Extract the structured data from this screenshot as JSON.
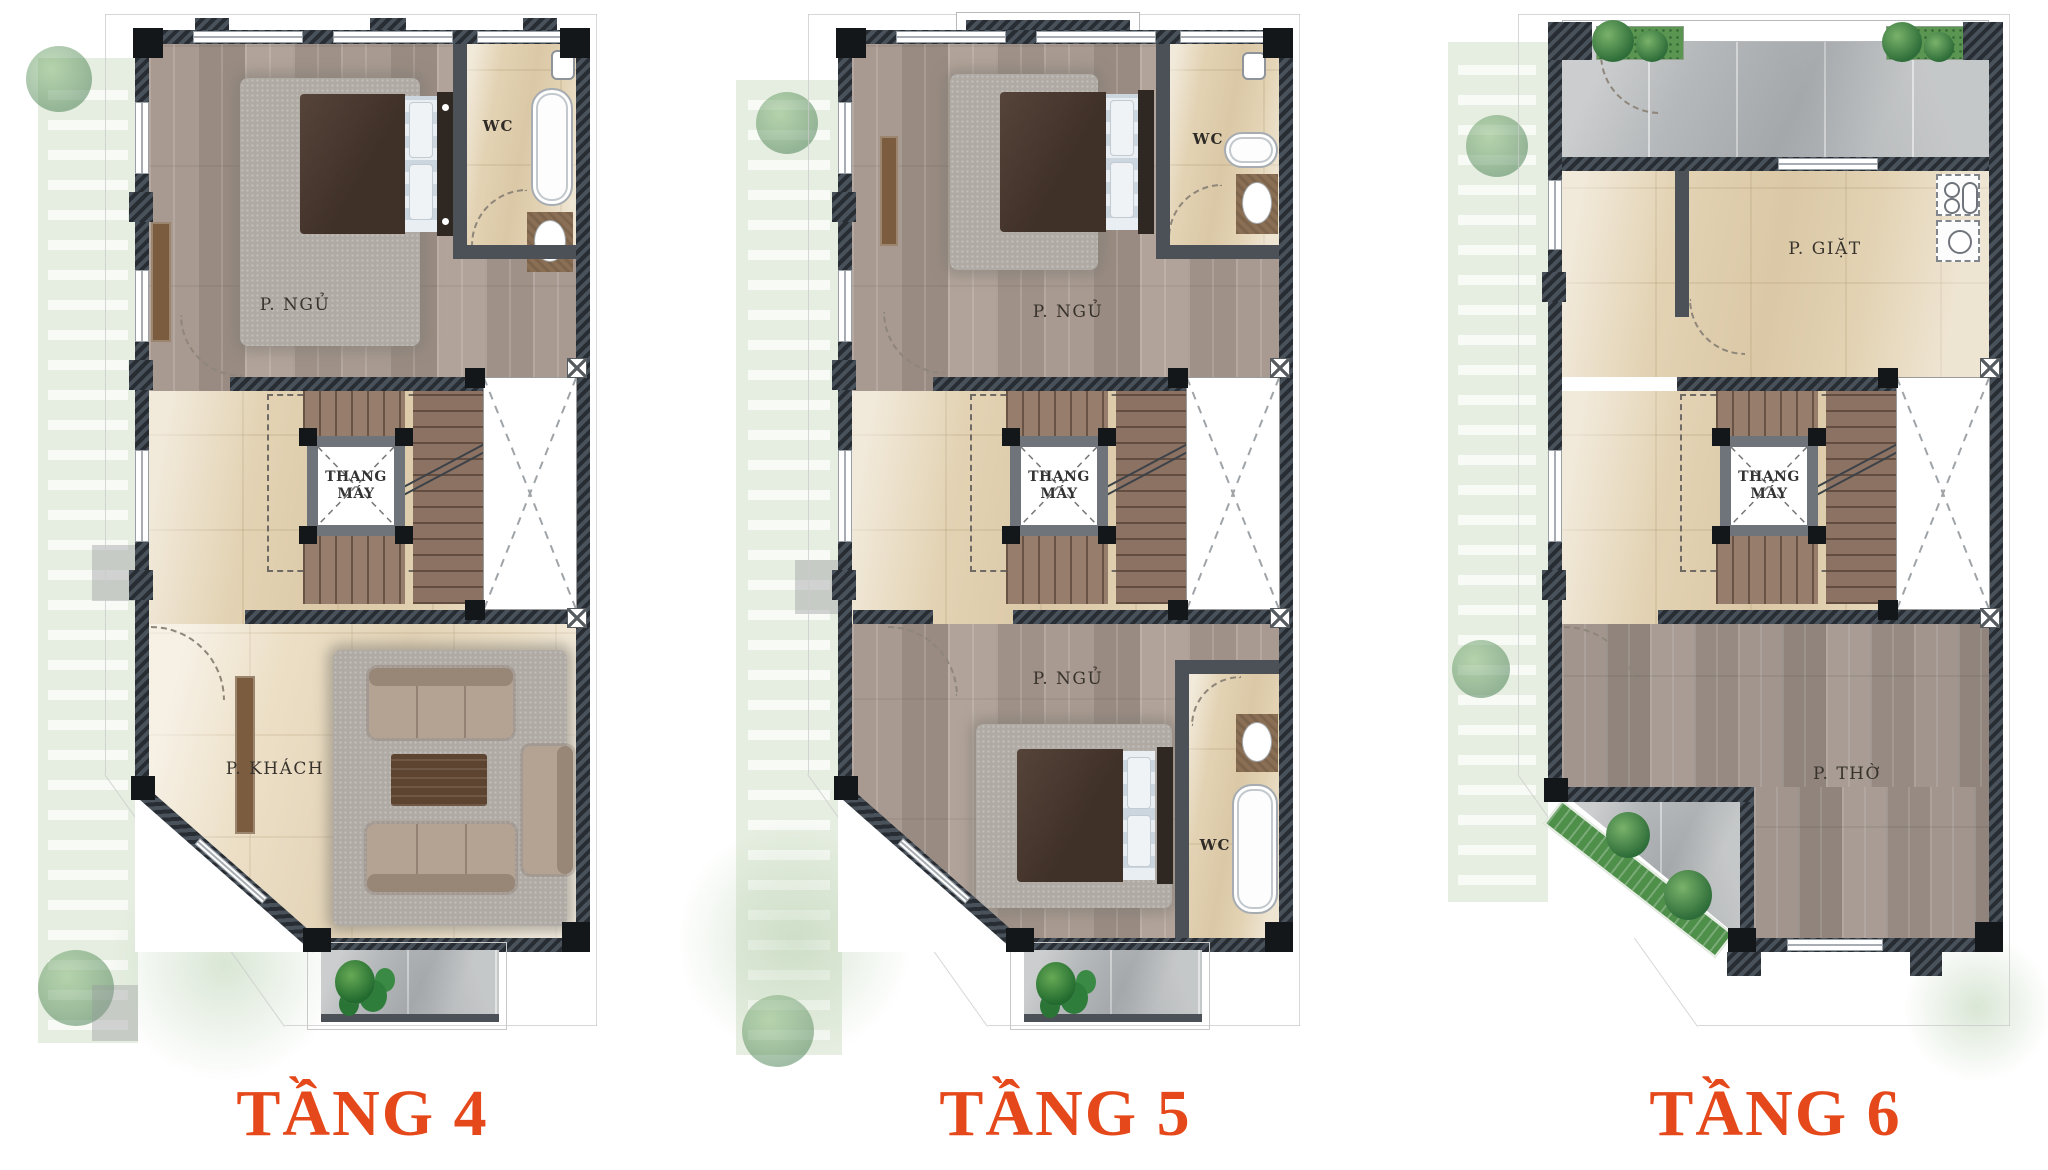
{
  "figure": {
    "type": "floor-plan-sheet",
    "accent_color": "#E5491B",
    "wall_color": "#2F353B"
  },
  "floors": [
    {
      "title": "TẦNG 4",
      "rooms": {
        "bedroom": "P. NGỦ",
        "wc": "WC",
        "elevator": "THANG MÁY",
        "living": "P. KHÁCH"
      }
    },
    {
      "title": "TẦNG 5",
      "rooms": {
        "bedroom1": "P. NGỦ",
        "wc1": "WC",
        "elevator": "THANG MÁY",
        "bedroom2": "P. NGỦ",
        "wc2": "WC"
      }
    },
    {
      "title": "TẦNG 6",
      "rooms": {
        "laundry": "P. GIẶT",
        "elevator": "THANG MÁY",
        "worship": "P. THỜ"
      }
    }
  ]
}
